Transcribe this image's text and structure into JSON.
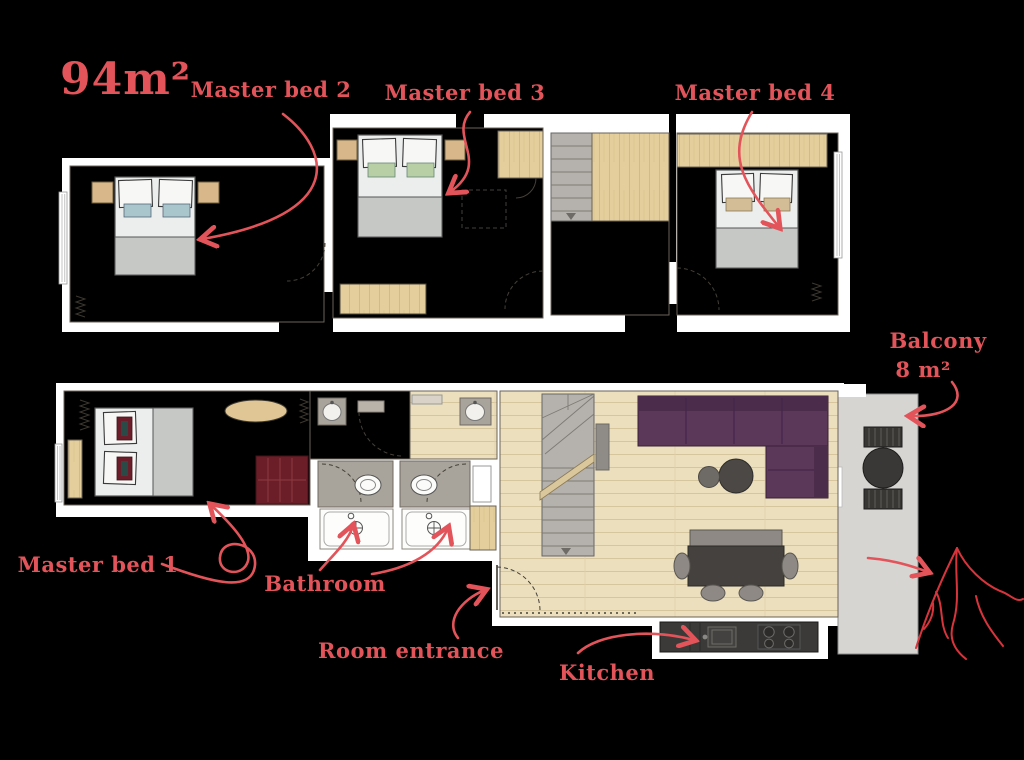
{
  "annotations": {
    "area": "94m²",
    "master_bed_1": "Master bed 1",
    "master_bed_2": "Master bed 2",
    "master_bed_3": "Master bed 3",
    "master_bed_4": "Master bed 4",
    "balcony": "Balcony",
    "balcony_size": "8 m²",
    "bathroom": "Bathroom",
    "room_entrance": "Room entrance",
    "kitchen": "Kitchen"
  },
  "colors": {
    "background": "#000000",
    "annotation_accent": "#e2545a",
    "wall_white": "#ffffff",
    "carpet_floor": "#dcd3c5",
    "wood_light": "#e4cf9c",
    "wood_plank_floor": "#ecdfbd",
    "stair_gray": "#b5b1ac",
    "sofa_purple": "#5b3759",
    "armchair_dark_red": "#6b1e27",
    "kitchen_counter_dark": "#3b3a38",
    "balcony_concrete": "#d7d5d2",
    "pillow_blue": "#a9c6cd",
    "pillow_green": "#b8cfa6",
    "pillow_tan": "#d2bd96",
    "bed_blanket_gray": "#c6c8c6"
  }
}
